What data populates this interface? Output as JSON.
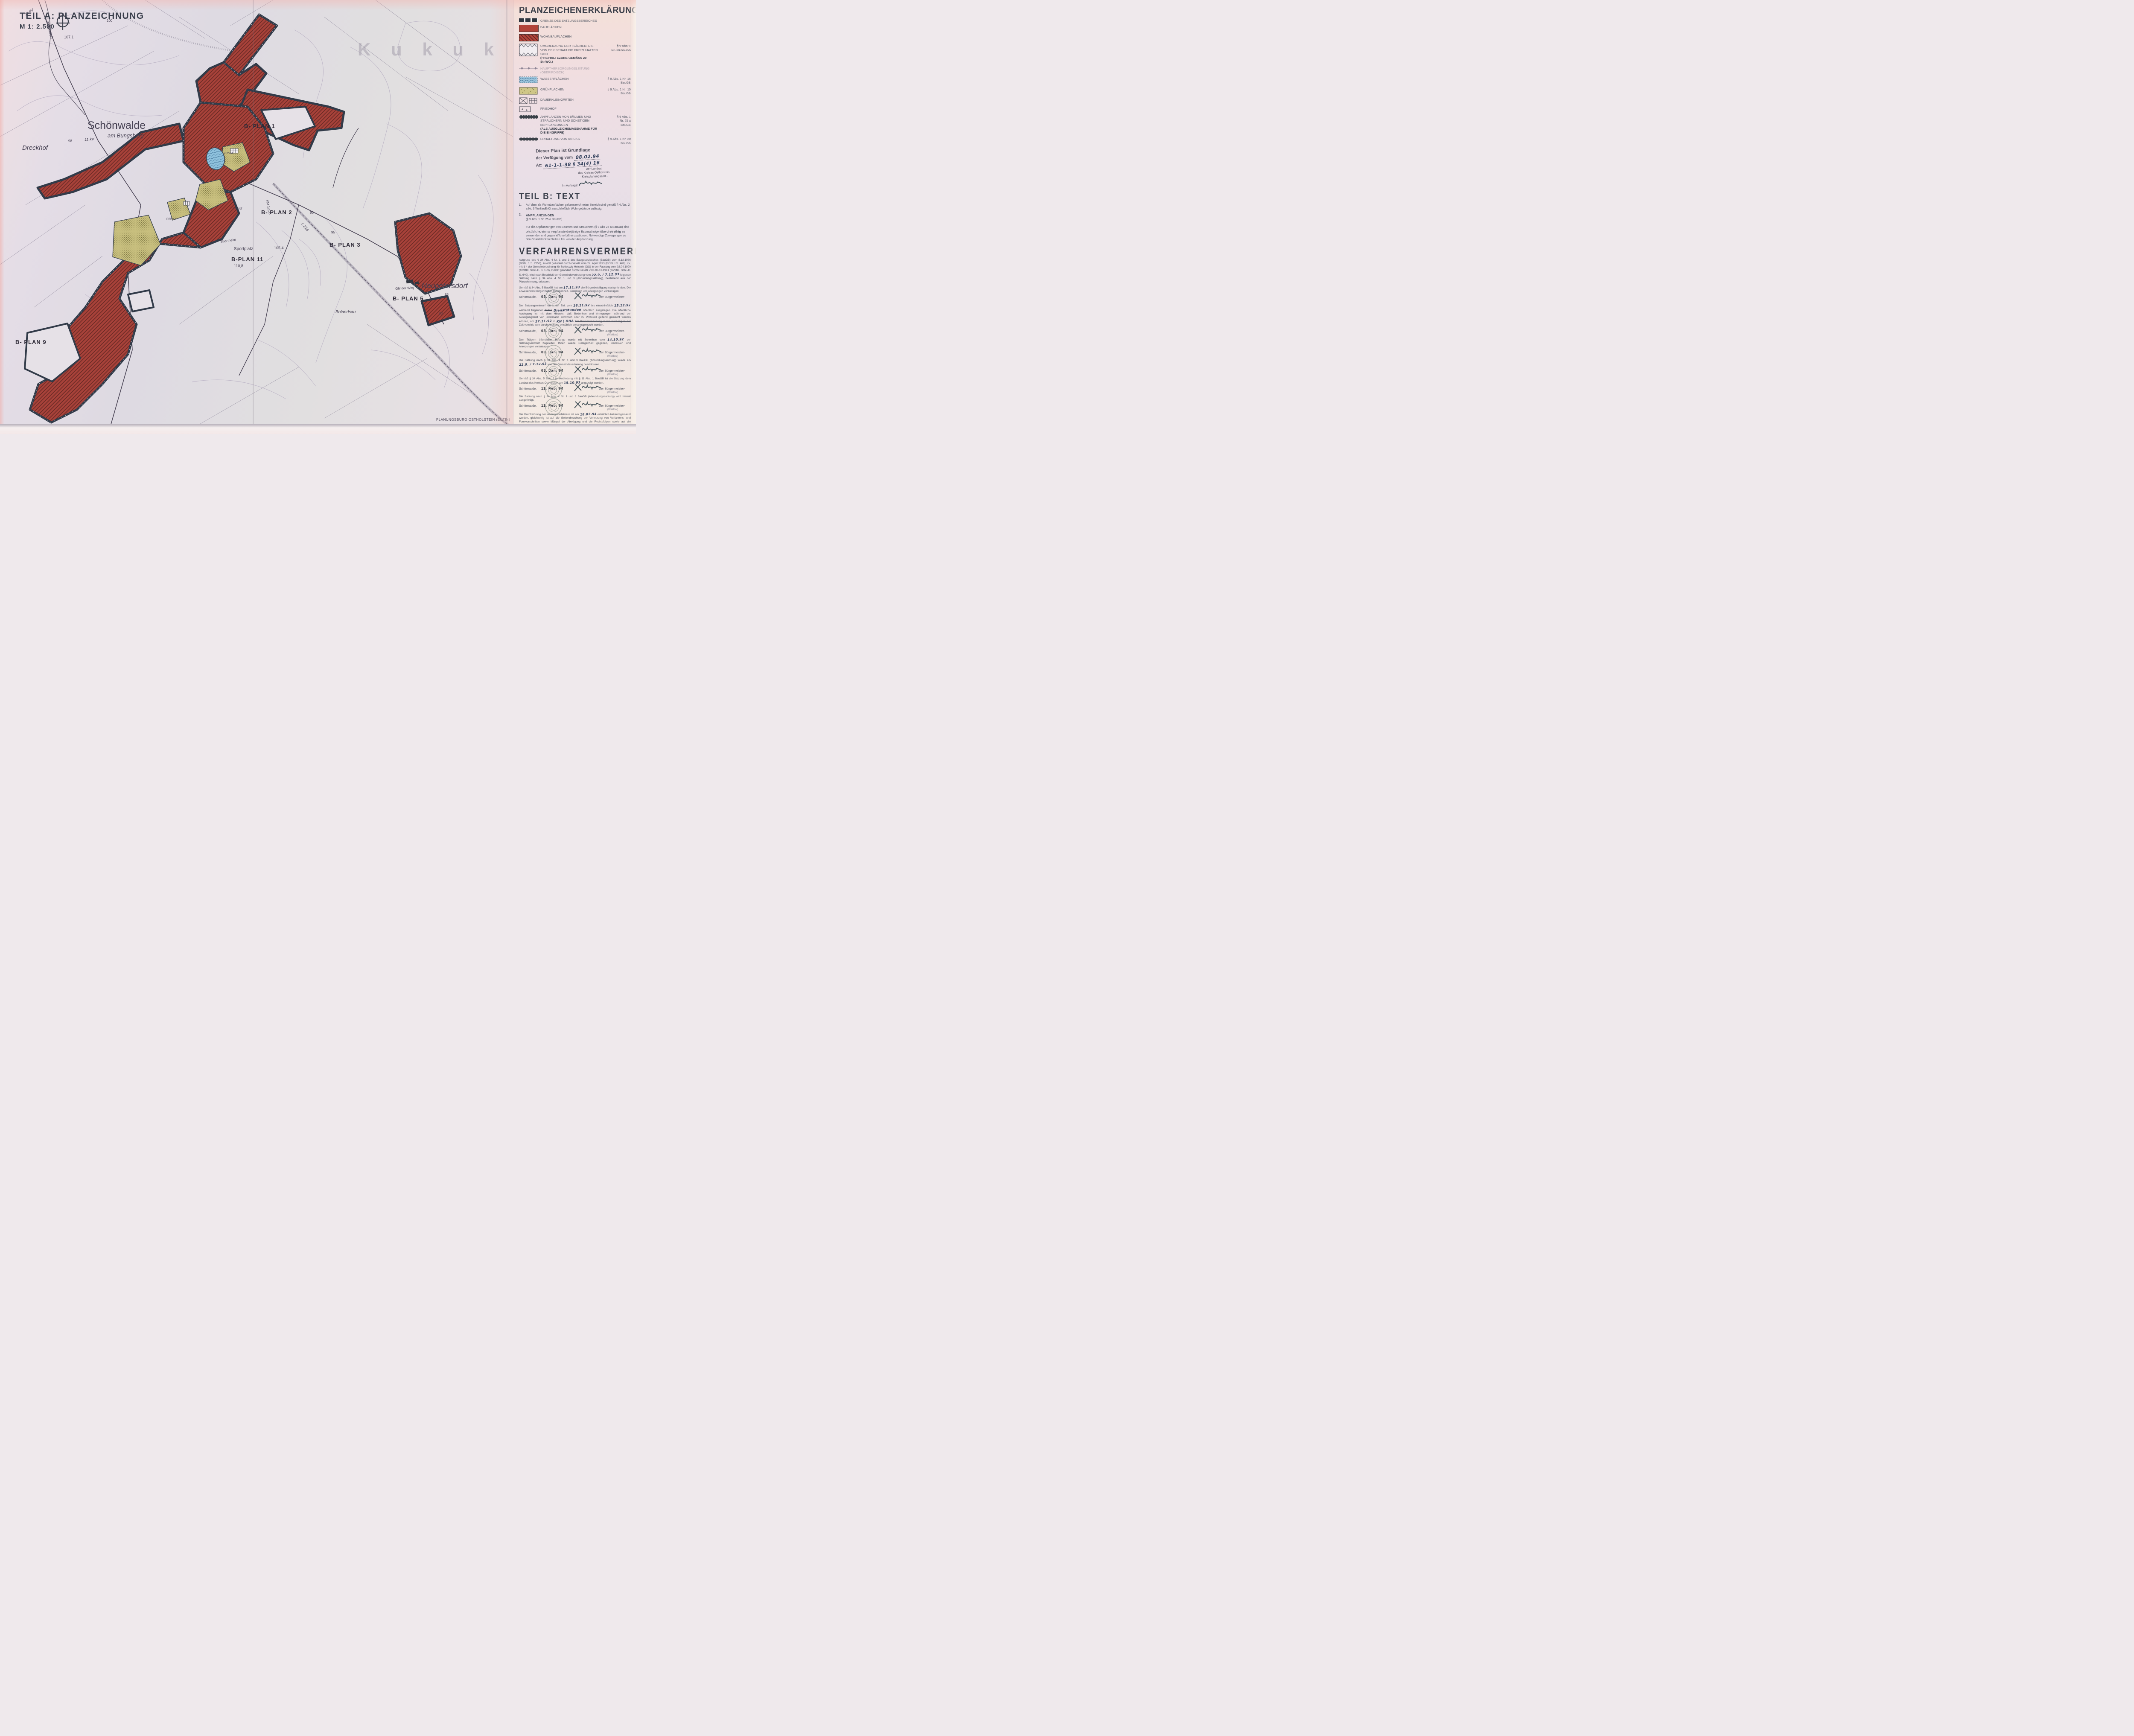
{
  "colors": {
    "built_red": "#a8423a",
    "boundary_dark": "#323b49",
    "green": "#c8bf7e",
    "water_blue": "#8fc2dd",
    "paper": "#ddd6df"
  },
  "title_block": {
    "part_a": "TEIL A: PLANZEICHNUNG",
    "scale": "M 1: 2.500"
  },
  "map": {
    "credit": "PLANUNGSBÜRO OSTHOLSTEIN (EUTIN)",
    "watermark": "K u k u k",
    "labels": [
      {
        "text": "Schönwalde"
      },
      {
        "text": "am Bungsberg"
      },
      {
        "text": "11 kV"
      },
      {
        "text": "11 kV"
      },
      {
        "text": "Dreckhof"
      },
      {
        "text": "Neupetersdorf"
      },
      {
        "text": "B- PLAN 1"
      },
      {
        "text": "B- PLAN 2"
      },
      {
        "text": "B- PLAN 3"
      },
      {
        "text": "B-PLAN 11"
      },
      {
        "text": "B- PLAN 5"
      },
      {
        "text": "B- PLAN 9"
      },
      {
        "text": "Sportplatz"
      },
      {
        "text": "Sportheim"
      },
      {
        "text": "Glinder Weg"
      },
      {
        "text": "Lachsbach"
      },
      {
        "text": "L 216"
      },
      {
        "text": "KM 12,05"
      },
      {
        "text": "Bolandsau"
      },
      {
        "text": "PRIVAT"
      },
      {
        "text": "PRIVAT"
      },
      {
        "text": "PRIVAT"
      },
      {
        "text": "107,1"
      },
      {
        "text": "105,4"
      },
      {
        "text": "110,8"
      },
      {
        "text": "98"
      },
      {
        "text": "95"
      },
      {
        "text": "85"
      },
      {
        "text": "80"
      },
      {
        "text": "90"
      },
      {
        "text": "100"
      }
    ]
  },
  "legend": {
    "heading": "PLANZEICHENERKLÄRUNG",
    "items": [
      {
        "label": "GRENZE DES SATZUNGSBEREICHES",
        "ref": ""
      },
      {
        "label": "BAUFLÄCHEN",
        "ref": ""
      },
      {
        "label": "WOHNBAUFLÄCHEN",
        "ref": ""
      },
      {
        "label": "UMGRENZUNG DER FLÄCHEN, DIE VON DER BEBAUUNG FREIZUHALTEN SIND",
        "label_bold": "(FREIHALTEZONE GEMÄSS  29 Str.WG.)",
        "ref1": "§ 9 Abs. 1",
        "ref2": "Nr. 10 BauGB"
      },
      {
        "label": "HAUPTVERSORGUNGSLEITUNG",
        "label2": "(OBERIRDISCH)",
        "ref": ""
      },
      {
        "label": "WASSERFLÄCHEN",
        "ref": "§ 9 Abs. 1 Nr. 16 BauGB"
      },
      {
        "label": "GRÜNFLÄCHEN",
        "ref": "§ 9 Abs. 1 Nr. 15 BauGB"
      },
      {
        "label": "DAUERKLEINGÄRTEN",
        "ref": ""
      },
      {
        "label": "FRIEDHOF",
        "ref": ""
      },
      {
        "label": "ANPFLANZEN VON BÄUMEN UND STRÄUCHERN UND SONSTIGEN BEPFLANZUNGEN",
        "label_bold": "(ALS AUSGLEICHSMASSNAHME FÜR DIE EINGRIFFE)",
        "ref1": "§ 9 Abs. 1",
        "ref2": "Nr. 25 a",
        "ref3": "BauGB"
      },
      {
        "label": "ERHALTUNG VON KNICKS",
        "ref": "§ 9 Abs. 1 Nr. 20 BauGB"
      }
    ]
  },
  "approval_stamp": {
    "l1": "Dieser Plan ist Grundlage",
    "l2": "der Verfügung vom",
    "l2_hw": "08.02.94",
    "l3": "Az:",
    "l3_hw": "61-1-1-38 § 34(4) 16",
    "l4": "Der Landrat",
    "l5": "des Kreises Ostholstein",
    "l6": "- Kreisplanungsamt -",
    "l7": "Im Auftrage:"
  },
  "teil_b": {
    "heading": "TEIL B: TEXT",
    "n1": "1.",
    "t1": "Auf dem als Wohnbauflächen gekennzeichneten Bereich sind gemäß § 4 Abs. 2 a Nr. 3 WoBauErlG ausschließlich Wohngebäude zulässig.",
    "n2": "2.",
    "h2": "ANPFLANZUNGEN",
    "s2": "(§ 9 Abs. 1 Nr. 25 a BauGB)",
    "t2a": "Für die Anpflanzungen von Bäumen und Sträuchern (§ 9 Abs 25 a BauGB) sind ortsübliche, einmal verpflanzte dreijährige Baumschulgehölze",
    "t2b": "dreireihig",
    "t2c": "zu verwenden und gegen Wildverbiß einzuzäunen. Notwendige Zuwegungen zu den Grundstücken bleiben frei von der Anpflanzung."
  },
  "verfahren": {
    "heading": "VERFAHRENSVERMERKE",
    "p1a": "Aufgrund des § 34 Abs. 4 Nr. 1 und 3 des Baugesetzbuches (BauGB) vom 8.12.1986 (BGBl. 1 S. 2253), zuletzt geändert durch Gesetz vom 22. April 1993 (BGBl. I S. 466), i.V. mit § 4 der Gemeindeordnung für Schleswig-Holstein (GO) in der Fassung vom 02.04.1990 (GVOBl. Schl.-H. S. 159), zuletzt geändert durch Gesetz vom 06.12.1991 (GVOBl. Schl.-H. S. 640), wird nach Beschluß der Gemeindevertretung vom",
    "p1hw": "22.9. / 7.12.93",
    "p1b": "folgende Satzung nach § 34 Abs. 4 Nr. 1 und 3 (Abrundungssatzung), bestehend aus der Planzeichnung, erlassen:",
    "p2a": "Gemäß § 34 Abs. 5 BauGB hat am",
    "p2hw": "17.11.93",
    "p2b": "die Bürgerbeteiligung stattgefunden. Die anwesenden Bürger hatten Gelegenheit, Bedenken und Anregungen vorzutragen.",
    "p3a": "Der Satzungsentwurf hat in der Zeit vom",
    "p3hw1": "16.11.92",
    "p3b": "bis einschließlich",
    "p3hw2": "15.12.92",
    "p3c": "während folgender",
    "p3strike": "Zeiten",
    "p3hw3": "Dienststunden",
    "p3d": "öffentlich ausgelegen. Die öffentliche Auslegung ist mit dem Hinweis, daß Bedenken und Anregungen während der Auslegungsfrist von jedermann schriftlich oder zu Protokoll geltend gemacht werden können, am",
    "p3hw4": "27.11.92",
    "p3e": "in",
    "p3hw5": "KN | OHA",
    "p3strike2": "bei Bekanntmachung durch Aushang in der Zeit vom",
    "p3strike3": "bis zum",
    "p3strike4": "durch Aushang",
    "p3f": "ortsüblich bekanntgemacht worden.",
    "p4a": "Den Trägern öffentlicher Belange wurde mit Schreiben vom",
    "p4hw": "14.10.92",
    "p4b": "der Satzungsentwurf zugeleitet. Ihnen wurde Gelegenheit gegeben, Bedenken und Anregungen vorzutragen.",
    "p5a": "Die Satzung nach § 34 Abs. 4 Nr. 1 und 3 BauGB (Abrundungssatzung) wurde am",
    "p5hw": "22.9. / 7.12.93",
    "p5b": "von der Gemeindevertretung beschlossen.",
    "p6a": "Gemäß § 34 Abs. 5 Satz 2 in Verbindung mit § 11 Abs. 1 BauGB ist die Satzung dem Landrat des Kreises Ostholstein am",
    "p6hw": "15.10.93",
    "p6b": "angezeigt worden.",
    "p7": "Die Satzung nach § 34 Abs. 4 Nr. 1 und 3 BauGB (Abrundungssatzung) wird hiermit ausgefertigt.",
    "p8a": "Die Durchführung des Anzeigeverfahrens ist am",
    "p8hw": "18.02.94",
    "p8b": "ortsüblich bekanntgemacht worden, gleichzeitig ist auf die Geltendmachung der Verletzung von Verfahrens- und Formvorschriften sowie Mängel der Abwägung und die Rechtsfolgen sowie auf die Geltendmachung etwaiger Entschädigungsansprüche und über das Erlöschen von Entschädigungsansprüchen hingewiesen worden.",
    "p8bold": "Die Satzung ist mithin am folgenden Tag in Kraft getreten.",
    "city": "Schönwalde,",
    "role": "Der Bürgermeister-",
    "name": "(Waldow)",
    "sigs": [
      {
        "date": "03. Jan. 94"
      },
      {
        "date": "03. Jan. 94"
      },
      {
        "date": "03. Jan. 94"
      },
      {
        "date": "03. Jan. 94"
      },
      {
        "date": "11. Feb. 94"
      },
      {
        "date": "11. Feb. 94"
      },
      {
        "date": "18. Feb. 94"
      }
    ]
  },
  "satzung_title": {
    "l1": "SATZUNG DER GEMEINDE SCHÖNWALDE",
    "l2": "ÜBER DIE GRENZEN DER IM",
    "l3": "ZUSAMMENHANG BEBAUTEN ORTSTEILE",
    "l4": "UND ABRUNDUNG DER GEBIETE",
    "sub": "( Abrundungssatzung )",
    "name": "SCHÖNWALDE"
  }
}
